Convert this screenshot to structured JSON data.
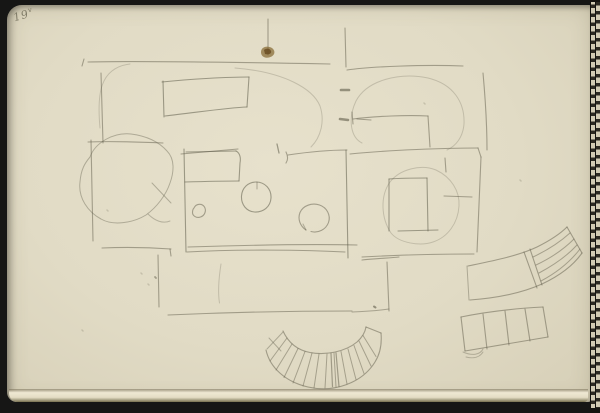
{
  "scene": {
    "folio": {
      "number": "19",
      "suffix": "v"
    },
    "colors": {
      "background": "#161615",
      "paper": "#e1dbc5",
      "paper_edge": "#efe8d3",
      "pencil": "#5f5c4a",
      "stain": "#8a6d3a",
      "stain_core": "#66491f",
      "stitch_dark": "#2c2921",
      "stitch_light": "#d2cbb3"
    }
  },
  "sketch": {
    "strokes": [
      {
        "name": "top-edge-line",
        "d": "M88,62 C140,60.5 250,62.5 330,64",
        "w": 1.1,
        "o": 0.5
      },
      {
        "name": "top-edge-tick",
        "d": "M82,66 L84,59",
        "w": 1.1,
        "o": 0.5
      },
      {
        "name": "top-center-vertical",
        "d": "M268,19 L268,55",
        "w": 1.1,
        "o": 0.5
      },
      {
        "name": "paper-stain",
        "d": "M261,52 C261,47 267,45 272,48 C276,51 275,56 269,57.5 C264,58.5 261,56 261,52 Z",
        "fill": "#8a6d3a",
        "o": 0.75
      },
      {
        "name": "paper-stain-core",
        "d": "M264,50 C266,48 270,48 271,51 C272,54 268,55 265,54 Z",
        "fill": "#66491f",
        "o": 0.8
      },
      {
        "name": "upper-right-vertical",
        "d": "M345,28 L346,67",
        "w": 1.1,
        "o": 0.5
      },
      {
        "name": "upper-right-room-top",
        "d": "M347,70 C370,66.5 425,64.5 463,66",
        "w": 1.1,
        "o": 0.5
      },
      {
        "name": "upper-right-room-right",
        "d": "M483,73 C485,95 487,125 487,150",
        "w": 1.1,
        "o": 0.5
      },
      {
        "name": "upper-right-inner-curve",
        "d": "M362,143 C350,137 348,118 356,101 C367,80 400,72 428,78 C453,84 465,102 464,124 C463,137 456,146 447,150",
        "w": 1,
        "o": 0.25
      },
      {
        "name": "upper-right-inner-top",
        "d": "M353,119 C375,116 408,115 428,116",
        "w": 1.1,
        "o": 0.5
      },
      {
        "name": "upper-right-inner-hook",
        "d": "M352,112 L353,124",
        "w": 1.1,
        "o": 0.5
      },
      {
        "name": "upper-right-inner-right",
        "d": "M428,116 L430,147",
        "w": 1.1,
        "o": 0.5
      },
      {
        "name": "door-mark-1",
        "d": "M341,90 L349,90",
        "w": 2.6,
        "o": 0.6
      },
      {
        "name": "door-mark-2",
        "d": "M340,119 L348,120",
        "w": 2.6,
        "o": 0.6
      },
      {
        "name": "door-mark-dash",
        "d": "M357,119 L371,120",
        "w": 1.1,
        "o": 0.5
      },
      {
        "name": "upper-left-vertical",
        "d": "M101,73 L103,143",
        "w": 1.1,
        "o": 0.5
      },
      {
        "name": "table-top",
        "d": "M162,82 C190,79 228,77 249,77",
        "w": 1.1,
        "o": 0.55
      },
      {
        "name": "table-right",
        "d": "M249,77 L247,107",
        "w": 1.1,
        "o": 0.55
      },
      {
        "name": "table-bottom",
        "d": "M247,107 C228,107.5 193,113 165,116",
        "w": 1.1,
        "o": 0.55
      },
      {
        "name": "table-left",
        "d": "M163,81 L164,117",
        "w": 1.1,
        "o": 0.55
      },
      {
        "name": "faint-corner-arc",
        "d": "M100,128 C97,95 99,68 130,64",
        "w": 1,
        "o": 0.25
      },
      {
        "name": "faint-center-arc",
        "d": "M235,68 C285,72 313,89 320,106 C325,121 321,137 311,147",
        "w": 1,
        "o": 0.25
      },
      {
        "name": "left-vertical",
        "d": "M91,140 L93,241",
        "w": 1.1,
        "o": 0.5
      },
      {
        "name": "left-horizontal",
        "d": "M88,142 C112,141 140,142 163,143",
        "w": 1.1,
        "o": 0.5
      },
      {
        "name": "boulder-outline",
        "d": "M90,157 C95,143 113,132 131,134 C147,136 159,142 167,151 C175,159 174,172 170,183 C166,195 157,207 146,215 C133,223 113,226 101,219 C88,212 78,198 80,182 C81,169 85,163 90,157",
        "w": 1,
        "o": 0.4
      },
      {
        "name": "boulder-inner-line",
        "d": "M152,183 L171,203",
        "w": 1,
        "o": 0.4
      },
      {
        "name": "boulder-tail",
        "d": "M148,214 C155,221 163,224 170,221",
        "w": 1,
        "o": 0.35
      },
      {
        "name": "center-room-left",
        "d": "M184,149 L186,252",
        "w": 1.1,
        "o": 0.55
      },
      {
        "name": "center-room-top-left",
        "d": "M181,154 L238,149",
        "w": 1.1,
        "o": 0.5
      },
      {
        "name": "center-top-tick",
        "d": "M277,144 L279,153",
        "w": 1.3,
        "o": 0.55
      },
      {
        "name": "center-top-hook",
        "d": "M286,152 C288,156 288,160 286,163",
        "w": 1.1,
        "o": 0.5
      },
      {
        "name": "center-room-top-right",
        "d": "M288,155 C308,152 330,150 347,150",
        "w": 1.1,
        "o": 0.5
      },
      {
        "name": "center-table-top",
        "d": "M186,152 L236,151",
        "w": 1.1,
        "o": 0.55
      },
      {
        "name": "center-table-right",
        "d": "M236,151 C240,153 241,158 240,163 L239,181",
        "w": 1.1,
        "o": 0.55
      },
      {
        "name": "center-table-bottom",
        "d": "M185,182 C202,181.5 222,181 239,181",
        "w": 1.1,
        "o": 0.55
      },
      {
        "name": "round-table",
        "d": "M256,182 C265,182 271.5,189 271,198 C270.5,207 263,212.5 254.5,212 C246.5,211.5 241,204.5 241.5,196 C242,188 248,182 256,182",
        "w": 1.1,
        "o": 0.55
      },
      {
        "name": "round-table-tick",
        "d": "M257,182 L257,189",
        "w": 1,
        "o": 0.45
      },
      {
        "name": "small-stool",
        "d": "M194,208 C196,203.5 202,203 204.5,207 C206.5,210.5 205,215.5 200.5,217 C196.5,218.3 192.5,216 192.5,212.5 C192.5,210.5 193,209 194,208",
        "w": 1.1,
        "o": 0.5
      },
      {
        "name": "horseshoe-seat",
        "d": "M306,230 C300,226 297.5,219 300,212.5 C303,205.5 312,202.5 319.5,205 C327,207.5 331,215.5 328.5,222.5 C326,229.5 318,233.5 311,231.5",
        "w": 1.1,
        "o": 0.5
      },
      {
        "name": "horseshoe-notch",
        "d": "M306,230 L303,224",
        "w": 1,
        "o": 0.4
      },
      {
        "name": "center-room-bottom",
        "d": "M188,247 C235,245.5 310,244 357,245",
        "w": 1.1,
        "o": 0.5
      },
      {
        "name": "center-room-right",
        "d": "M346,150 L348,258",
        "w": 1.1,
        "o": 0.55
      },
      {
        "name": "right-room-top",
        "d": "M350,154 C390,150 445,148 478,148",
        "w": 1.1,
        "o": 0.5
      },
      {
        "name": "right-room-corner",
        "d": "M478,148 L481,157",
        "w": 1.1,
        "o": 0.5
      },
      {
        "name": "right-room-right",
        "d": "M481,157 L477,252",
        "w": 1.1,
        "o": 0.5
      },
      {
        "name": "right-room-bottom",
        "d": "M362,257 C398,255 440,254 474,254",
        "w": 1.1,
        "o": 0.5
      },
      {
        "name": "right-room-inner-blob",
        "d": "M391,233 C381,218 380,196 390,182 C400,169 421,164 436,170 C451,177 460,191 459,206 C458,223 448,237 433,242 C420,246.5 399,243 391,233",
        "w": 1,
        "o": 0.25
      },
      {
        "name": "cabinet-left",
        "d": "M389,179 L389,231",
        "w": 1.1,
        "o": 0.55
      },
      {
        "name": "cabinet-top",
        "d": "M389,179 C402,178 416,178 427,178",
        "w": 1.1,
        "o": 0.55
      },
      {
        "name": "cabinet-right",
        "d": "M427,178 L428,231",
        "w": 1.1,
        "o": 0.55
      },
      {
        "name": "cabinet-bottom",
        "d": "M398,231 L438,230",
        "w": 1.1,
        "o": 0.55
      },
      {
        "name": "right-room-dash",
        "d": "M444,196 L472,197",
        "w": 1.1,
        "o": 0.5
      },
      {
        "name": "right-room-small-vert",
        "d": "M445,158 L446,172",
        "w": 1.1,
        "o": 0.5
      },
      {
        "name": "lower-left-horizontal",
        "d": "M102,248 C125,247 150,247.5 171,249",
        "w": 1.1,
        "o": 0.5
      },
      {
        "name": "lower-left-hook",
        "d": "M170,249 L171,256",
        "w": 1.1,
        "o": 0.5
      },
      {
        "name": "lower-left-vertical",
        "d": "M158,255 L159,307",
        "w": 1.1,
        "o": 0.5
      },
      {
        "name": "bottom-rect-top",
        "d": "M187,252 C240,249 305,250 345,252",
        "w": 1.1,
        "o": 0.5
      },
      {
        "name": "bottom-rect-top-2",
        "d": "M362,260 C375,258.5 390,258 399,257",
        "w": 1.1,
        "o": 0.5
      },
      {
        "name": "bottom-rect-right",
        "d": "M387,262 L389,311",
        "w": 1.1,
        "o": 0.5
      },
      {
        "name": "bottom-rect-bottom",
        "d": "M168,315 C225,312.5 300,311 352,311",
        "w": 1.1,
        "o": 0.5
      },
      {
        "name": "bottom-rect-bottom-2",
        "d": "M352,312 C365,311.5 378,310.5 389,309",
        "w": 1,
        "o": 0.45
      },
      {
        "name": "bottom-rect-inner-faint",
        "d": "M221,264 C218.5,280 218,294 219.5,303",
        "w": 1,
        "o": 0.25
      },
      {
        "name": "pencil-dot-1",
        "d": "M374,306.5 L375.5,307.5",
        "w": 2,
        "o": 0.6
      },
      {
        "name": "pencil-dot-2",
        "d": "M155,277 L156,278",
        "w": 1.8,
        "o": 0.5
      },
      {
        "name": "stair-fan-outer",
        "d": "M266,350 C270,368 286,382 308,387 C334,393 362,383 375,362 C380,354 382,344 381,333",
        "w": 1.1,
        "o": 0.5
      },
      {
        "name": "stair-fan-inner",
        "d": "M283,331 C288,342 297,350 310,352.5 C325,355.5 345,352 357,342 C362,337.5 365,333 366,327",
        "w": 1.1,
        "o": 0.5
      },
      {
        "name": "stair-fan-left-cap",
        "d": "M267,349 L283,332",
        "w": 1,
        "o": 0.4
      },
      {
        "name": "stair-fan-left-dash",
        "d": "M269,338 L281,351",
        "w": 1,
        "o": 0.4
      },
      {
        "name": "stair-fan-right-cap",
        "d": "M366,327 L381,333",
        "w": 1.1,
        "o": 0.5
      },
      {
        "name": "stair-fan-treads",
        "d": "M287,338 L270,361 M292,344 L276,370 M298,348.5 L284,377.5 M305,351.5 L293,383 M312,353 L303,386 M319,354 L314,388 M327,354 L325,388 M334,353 L336,387 M341,351.5 L347,384 M348,349 L356,379.5 M354,345.5 L364,373.5 M359,341 L371,366 M363,335.5 L376,356.5",
        "w": 1,
        "o": 0.45
      },
      {
        "name": "stair-fan-double-tread",
        "d": "M331,353.4 L332.5,386.6 M336,352.8 L339,386.5",
        "w": 1.2,
        "o": 0.5
      },
      {
        "name": "ramp-outer",
        "d": "M468,266 C492,261 518,256 537,247 C551,240 560,234 567,227",
        "w": 1.1,
        "o": 0.5
      },
      {
        "name": "ramp-inner",
        "d": "M470,300 C497,298 522,293 542,284 C559,276 573,266 582,253",
        "w": 1.1,
        "o": 0.5
      },
      {
        "name": "ramp-left-cap",
        "d": "M467,266 L469,300",
        "w": 1,
        "o": 0.4
      },
      {
        "name": "ramp-right-cap",
        "d": "M567,227 L582,253",
        "w": 1.1,
        "o": 0.5
      },
      {
        "name": "ramp-divider",
        "d": "M524,252 L537,288 M530,249 L542,285",
        "w": 1.1,
        "o": 0.5
      },
      {
        "name": "ramp-stripes",
        "d": "M533,257 C548,250 560,242 570,233 M536,265 C551,258 564,249 574,239 M539,273 C554,265 567,256 577,245 M541,281 C556,273 570,262 580,249",
        "w": 1,
        "o": 0.45
      },
      {
        "name": "squares-strip-top",
        "d": "M461,317 C485,312 515,308.5 543,307",
        "w": 1.1,
        "o": 0.5
      },
      {
        "name": "squares-strip-bottom",
        "d": "M465,351 C490,347 518,342 548,337",
        "w": 1.1,
        "o": 0.5
      },
      {
        "name": "squares-strip-left",
        "d": "M461,317 L465,351",
        "w": 1.1,
        "o": 0.5
      },
      {
        "name": "squares-strip-right",
        "d": "M543,307 L548,337",
        "w": 1.1,
        "o": 0.5
      },
      {
        "name": "squares-strip-dividers",
        "d": "M483,314 L487,349 M505,311 L509,345 M525,309 L530,341",
        "w": 1.1,
        "o": 0.5
      },
      {
        "name": "squares-strip-flap",
        "d": "M463,352 C472,356 480,355 483,349 M466,357 C474,359 480,357 483,352",
        "w": 1,
        "o": 0.35
      },
      {
        "name": "paper-specks",
        "d": "M141,273 L142,274 M148,284 L149,285 M107,210 L108,211 M424,103 L425,104 M520,180 L521,181 M82,330 L83,331",
        "w": 1.5,
        "o": 0.22
      }
    ]
  }
}
